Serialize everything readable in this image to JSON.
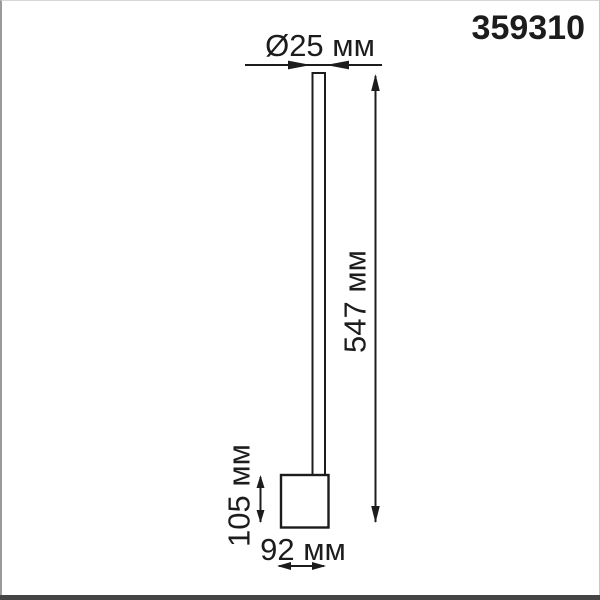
{
  "product_code": "359310",
  "dimensions": {
    "diameter": "Ø25 мм",
    "height": "547 мм",
    "base_height": "105 мм",
    "base_width": "92 мм"
  },
  "colors": {
    "line": "#1c1c1c",
    "text": "#1c1c1c",
    "background": "#ffffff",
    "border": "#9a9a9a",
    "bottom_bar": "#454545"
  }
}
